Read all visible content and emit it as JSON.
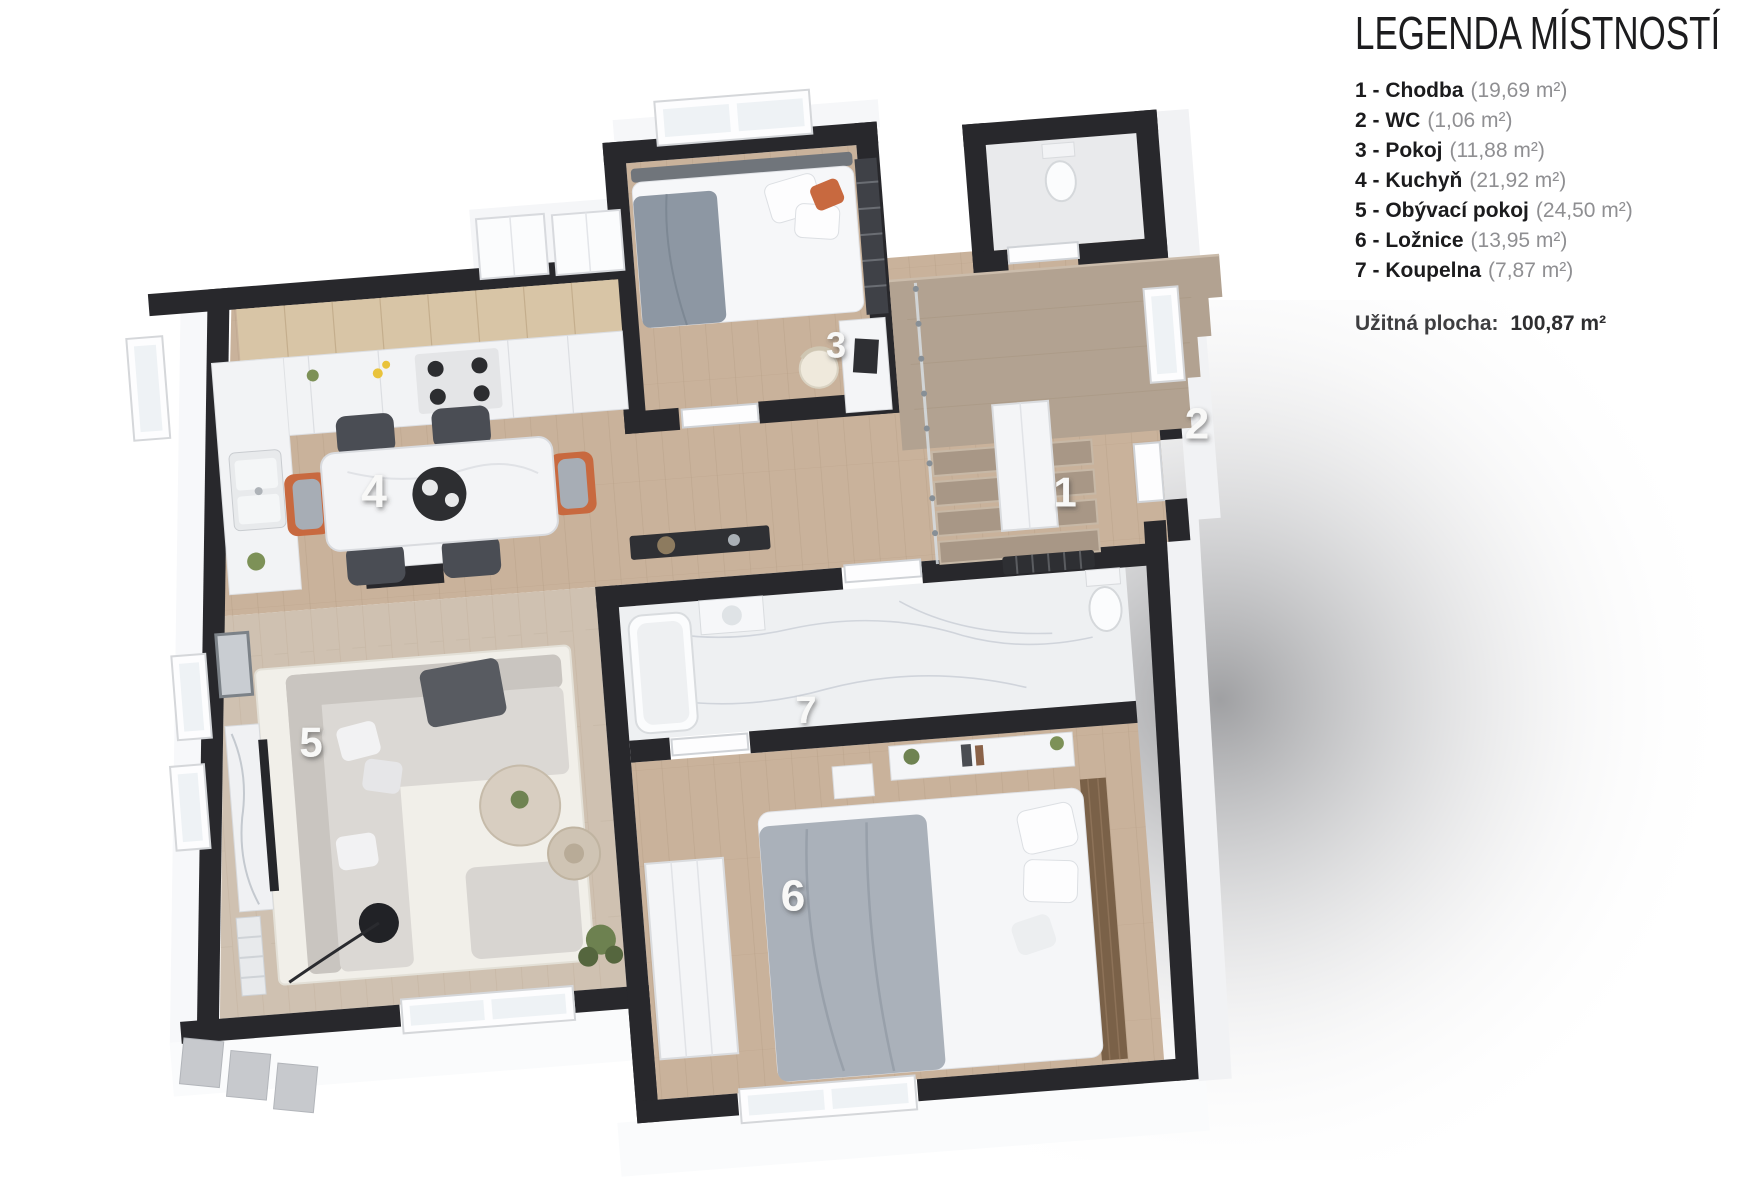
{
  "page": {
    "floor_label": "1.NP"
  },
  "legend": {
    "title": "LEGENDA MÍSTNOSTÍ",
    "separator": " - ",
    "rooms": [
      {
        "number": "1",
        "name": "Chodba",
        "area": "(19,69 m²)"
      },
      {
        "number": "2",
        "name": "WC",
        "area": "(1,06 m²)"
      },
      {
        "number": "3",
        "name": "Pokoj",
        "area": "(11,88 m²)"
      },
      {
        "number": "4",
        "name": "Kuchyň",
        "area": "(21,92 m²)"
      },
      {
        "number": "5",
        "name": "Obývací pokoj",
        "area": "(24,50 m²)"
      },
      {
        "number": "6",
        "name": "Ložnice",
        "area": "(13,95 m²)"
      },
      {
        "number": "7",
        "name": "Koupelna",
        "area": "(7,87 m²)"
      }
    ],
    "total_label": "Užitná plocha:",
    "total_value": "100,87 m²"
  },
  "plan": {
    "type": "floor-plan-3d",
    "floor_shown": "1.NP",
    "colors": {
      "wall": "#28282c",
      "wood_floor": "#c9b29b",
      "wood_floor_light": "#cfc1b1",
      "marble_floor": "#eef0f2",
      "stair_wood": "#b2a291",
      "tread_wood": "#a89786",
      "cabinet_wood": "#d8c5a6",
      "accent_orange": "#c8693f",
      "room_number": "#f8f8f7"
    }
  }
}
